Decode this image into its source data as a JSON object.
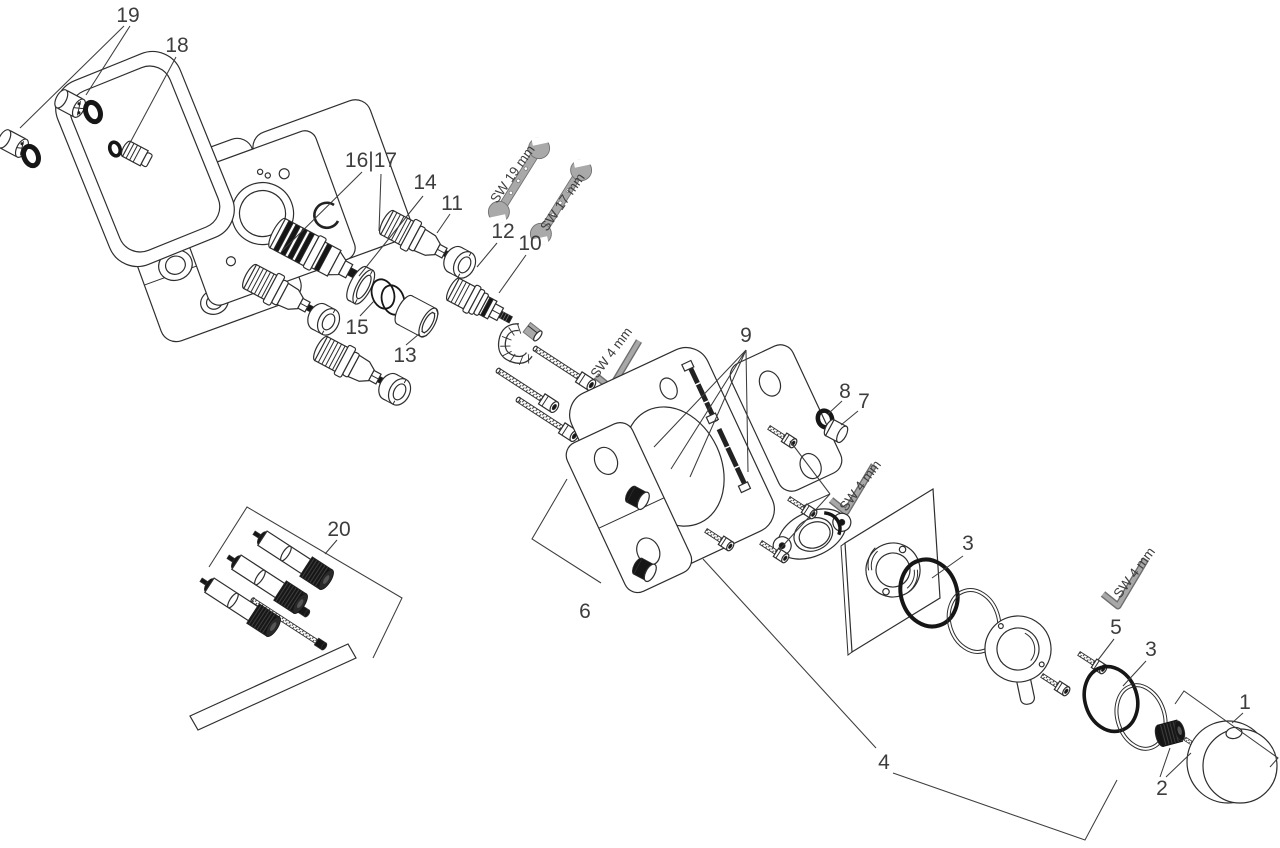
{
  "diagram": {
    "type": "exploded-parts-diagram",
    "callouts": {
      "n1": "1",
      "n2": "2",
      "n3": "3",
      "n4": "4",
      "n5": "5",
      "n6": "6",
      "n7": "7",
      "n8": "8",
      "n9": "9",
      "n10": "10",
      "n11": "11",
      "n12": "12",
      "n13": "13",
      "n14": "14",
      "n15": "15",
      "n16_17": "16|17",
      "n18": "18",
      "n19": "19",
      "n20": "20"
    },
    "tools": {
      "open_end_wrench_19": "SW 19 mm",
      "open_end_wrench_17": "SW 17 mm",
      "hex_key_4": "SW 4 mm"
    },
    "colors": {
      "line": "#2e2e2e",
      "label": "#3d3d3d",
      "tool_fill": "#a9a9a9",
      "tool_outline": "#707070",
      "black_part": "#161616"
    }
  }
}
